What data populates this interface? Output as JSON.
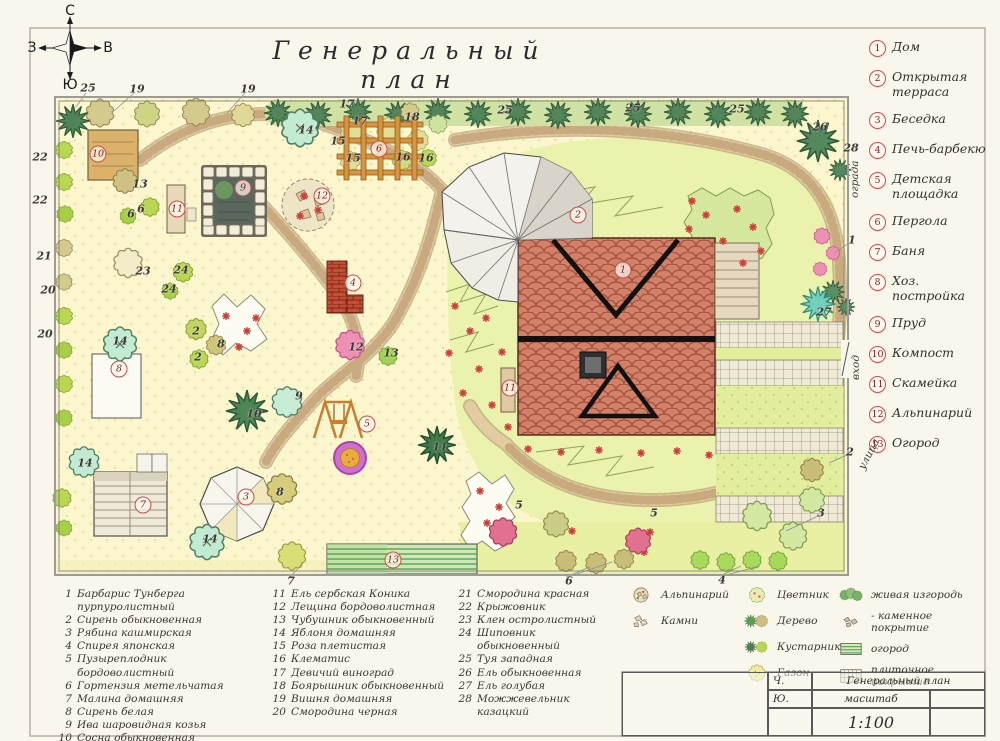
{
  "title": "Генеральный план",
  "compass": {
    "n": "С",
    "s": "Ю",
    "w": "З",
    "e": "В"
  },
  "edge_labels": {
    "fence": "ограда",
    "entrance": "вход",
    "street": "улица"
  },
  "legend": {
    "facilities": [
      {
        "n": "1",
        "label": "Дом"
      },
      {
        "n": "2",
        "label": "Открытая\nтерраса"
      },
      {
        "n": "3",
        "label": "Беседка"
      },
      {
        "n": "4",
        "label": "Печь-барбекю"
      },
      {
        "n": "5",
        "label": "Детская\nплощадка"
      },
      {
        "n": "6",
        "label": "Пергола"
      },
      {
        "n": "7",
        "label": "Баня"
      },
      {
        "n": "8",
        "label": "Хоз. постройка"
      },
      {
        "n": "9",
        "label": "Пруд"
      },
      {
        "n": "10",
        "label": "Компост"
      },
      {
        "n": "11",
        "label": "Скамейка"
      },
      {
        "n": "12",
        "label": "Альпинарий"
      },
      {
        "n": "13",
        "label": "Огород"
      }
    ],
    "plants": [
      "Барбарис Тунберга пурпуролистный",
      "Сирень обыкновенная",
      "Рябина кашмирская",
      "Спирея японская",
      "Пузыреплодник бордоволистный",
      "Гортензия метельчатая",
      "Малина домашняя",
      "Сирень белая",
      "Ива шаровидная козья",
      "Сосна обыкновенная",
      "Ель сербская Коника",
      "Лещина бордоволистная",
      "Чубушник обыкновенный",
      "Яблоня домашняя",
      "Роза плетистая",
      "Клематис",
      "Девичий виноград",
      "Боярышник обыкновенный",
      "Вишня домашняя",
      "Смородина черная",
      "Смородина красная",
      "Крыжовник",
      "Клен остролистный",
      "Шиповник обыкновенный",
      "Туя западная",
      "Ель обыкновенная",
      "Ель голубая",
      "Можжевельник\nказацкий"
    ],
    "symbols": {
      "groupA": [
        {
          "key": "alpinary",
          "icon": "alpinary-icon",
          "label": "Альпинарий"
        },
        {
          "key": "stones",
          "icon": "stones-icon",
          "label": "Камни"
        }
      ],
      "groupB": [
        {
          "key": "flowerbed",
          "icon": "flowerbed-icon",
          "label": "Цветник"
        },
        {
          "key": "tree",
          "icon": "tree-icon",
          "label": "Дерево"
        },
        {
          "key": "shrub",
          "icon": "shrub-icon",
          "label": "Кустарник"
        },
        {
          "key": "lawn",
          "icon": "lawn-icon",
          "label": "Газон"
        }
      ],
      "groupC": [
        {
          "key": "hedge",
          "icon": "hedge-icon",
          "label": "живая изгородь"
        },
        {
          "key": "stonepave",
          "icon": "stone-paving-icon",
          "label": "- каменное покрытие"
        },
        {
          "key": "gardenbed",
          "icon": "garden-bed-icon",
          "label": "огород"
        },
        {
          "key": "tilepave",
          "icon": "tile-paving-icon",
          "label": "плиточное покрытие"
        }
      ]
    }
  },
  "title_block": {
    "c1": "Ч.",
    "c2": "Ю.",
    "doc_title": "Генеральный план",
    "scale_label": "масштаб",
    "scale_value": "1:100"
  },
  "plan_markers": {
    "circled": [
      {
        "n": "1",
        "x": 623,
        "y": 270
      },
      {
        "n": "2",
        "x": 578,
        "y": 215
      },
      {
        "n": "3",
        "x": 246,
        "y": 497
      },
      {
        "n": "4",
        "x": 353,
        "y": 283
      },
      {
        "n": "5",
        "x": 367,
        "y": 424
      },
      {
        "n": "6",
        "x": 379,
        "y": 149
      },
      {
        "n": "7",
        "x": 143,
        "y": 505
      },
      {
        "n": "8",
        "x": 119,
        "y": 369
      },
      {
        "n": "9",
        "x": 243,
        "y": 188
      },
      {
        "n": "10",
        "x": 98,
        "y": 154
      },
      {
        "n": "11",
        "x": 177,
        "y": 209
      },
      {
        "n": "11",
        "x": 510,
        "y": 388
      },
      {
        "n": "12",
        "x": 322,
        "y": 196
      },
      {
        "n": "13",
        "x": 393,
        "y": 560
      }
    ],
    "plain": [
      {
        "n": "25",
        "x": 88,
        "y": 88
      },
      {
        "n": "19",
        "x": 137,
        "y": 89
      },
      {
        "n": "19",
        "x": 248,
        "y": 89
      },
      {
        "n": "17",
        "x": 347,
        "y": 104
      },
      {
        "n": "18",
        "x": 412,
        "y": 117
      },
      {
        "n": "17",
        "x": 360,
        "y": 121
      },
      {
        "n": "25",
        "x": 505,
        "y": 110
      },
      {
        "n": "25",
        "x": 633,
        "y": 108
      },
      {
        "n": "25",
        "x": 737,
        "y": 109
      },
      {
        "n": "26",
        "x": 820,
        "y": 127
      },
      {
        "n": "28",
        "x": 851,
        "y": 148
      },
      {
        "n": "14",
        "x": 306,
        "y": 130
      },
      {
        "n": "15",
        "x": 338,
        "y": 141
      },
      {
        "n": "15",
        "x": 353,
        "y": 158
      },
      {
        "n": "16",
        "x": 403,
        "y": 157
      },
      {
        "n": "16",
        "x": 426,
        "y": 158
      },
      {
        "n": "22",
        "x": 40,
        "y": 157
      },
      {
        "n": "22",
        "x": 40,
        "y": 200
      },
      {
        "n": "21",
        "x": 44,
        "y": 256
      },
      {
        "n": "20",
        "x": 48,
        "y": 290
      },
      {
        "n": "20",
        "x": 45,
        "y": 334
      },
      {
        "n": "13",
        "x": 140,
        "y": 184
      },
      {
        "n": "6",
        "x": 141,
        "y": 209
      },
      {
        "n": "6",
        "x": 131,
        "y": 214
      },
      {
        "n": "23",
        "x": 143,
        "y": 271
      },
      {
        "n": "24",
        "x": 181,
        "y": 270
      },
      {
        "n": "24",
        "x": 169,
        "y": 289
      },
      {
        "n": "2",
        "x": 196,
        "y": 331
      },
      {
        "n": "8",
        "x": 221,
        "y": 344
      },
      {
        "n": "2",
        "x": 198,
        "y": 357
      },
      {
        "n": "14",
        "x": 120,
        "y": 341
      },
      {
        "n": "14",
        "x": 85,
        "y": 463
      },
      {
        "n": "14",
        "x": 210,
        "y": 539
      },
      {
        "n": "9",
        "x": 299,
        "y": 396
      },
      {
        "n": "10",
        "x": 254,
        "y": 414
      },
      {
        "n": "8",
        "x": 280,
        "y": 492
      },
      {
        "n": "11",
        "x": 440,
        "y": 447
      },
      {
        "n": "12",
        "x": 356,
        "y": 347
      },
      {
        "n": "13",
        "x": 391,
        "y": 353
      },
      {
        "n": "1",
        "x": 852,
        "y": 240
      },
      {
        "n": "27",
        "x": 824,
        "y": 312
      },
      {
        "n": "2",
        "x": 850,
        "y": 452
      },
      {
        "n": "3",
        "x": 821,
        "y": 513
      },
      {
        "n": "5",
        "x": 519,
        "y": 505
      },
      {
        "n": "5",
        "x": 654,
        "y": 513
      },
      {
        "n": "7",
        "x": 291,
        "y": 581
      },
      {
        "n": "6",
        "x": 569,
        "y": 581
      },
      {
        "n": "4",
        "x": 722,
        "y": 580
      }
    ]
  }
}
